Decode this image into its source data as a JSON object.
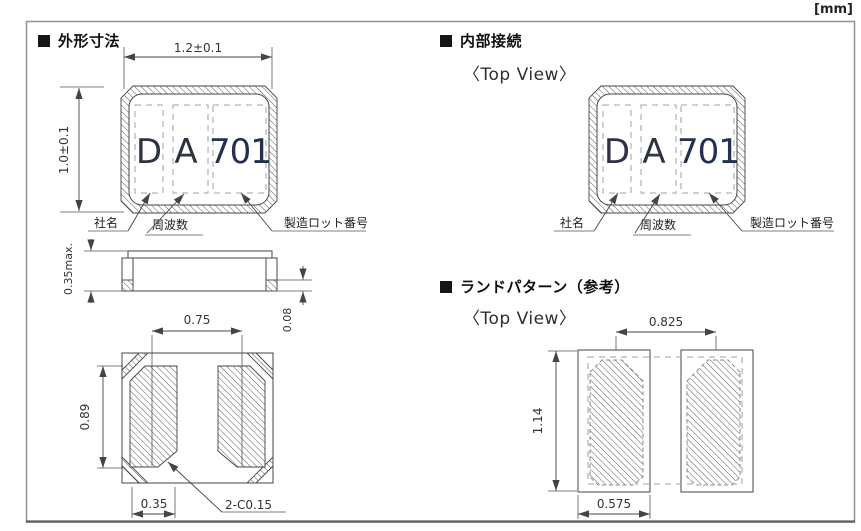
{
  "unit_label": "[mm]",
  "sections": {
    "outline": {
      "title": "外形寸法"
    },
    "internal": {
      "title": "内部接続",
      "view_label": "〈Top View〉"
    },
    "land_pattern": {
      "title": "ランドパターン（参考）",
      "view_label": "〈Top View〉"
    }
  },
  "marking": {
    "company_code": "D",
    "frequency_code": "A",
    "lot_code": "701"
  },
  "marking_labels": {
    "company": "社名",
    "frequency": "周波数",
    "lot": "製造ロット番号"
  },
  "dimensions": {
    "body_width": "1.2±0.1",
    "body_height": "1.0±0.1",
    "body_thickness": "0.35max.",
    "electrode_thickness": "0.08",
    "pad_pitch": "0.75",
    "pad_length": "0.89",
    "pad_width": "0.35",
    "pad_chamfer": "2-C0.15",
    "land_pitch": "0.825",
    "land_length": "1.14",
    "land_width": "0.575"
  },
  "colors": {
    "line": "#444444",
    "marking_text": "#2e3340",
    "marking_lot_text": "#233052",
    "frame_border": "#979797"
  }
}
